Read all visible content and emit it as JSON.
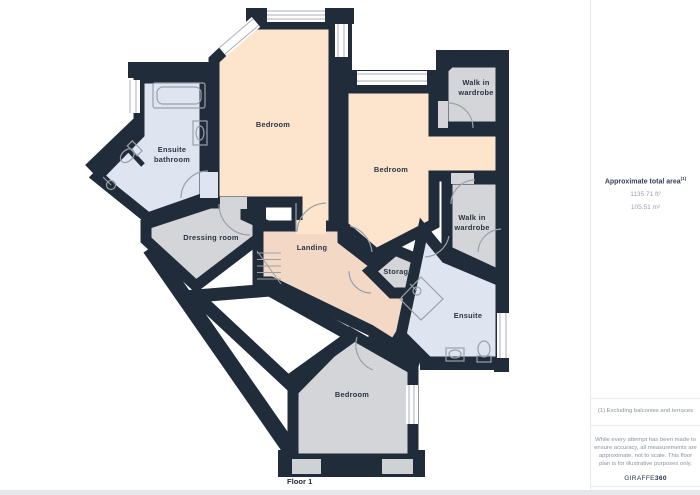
{
  "floorplan": {
    "floor_label": "Floor 1",
    "rooms": {
      "bedroom_top": "Bedroom",
      "bedroom_right": "Bedroom",
      "bedroom_bottom": "Bedroom",
      "ensuite_bathroom_l1": "Ensuite",
      "ensuite_bathroom_l2": "bathroom",
      "wiw_top_l1": "Walk in",
      "wiw_top_l2": "wardrobe",
      "wiw_bottom_l1": "Walk in",
      "wiw_bottom_l2": "wardrobe",
      "dressing_room": "Dressing room",
      "landing": "Landing",
      "storage": "Storage",
      "ensuite": "Ensuite"
    },
    "colors": {
      "wall": "#212c3a",
      "bedroom_fill": "#fce5cc",
      "landing_fill": "#f3d8c6",
      "ensuite_fill": "#dee4f0",
      "utility_fill": "#d3d5d8",
      "door_arc": "#9aa1ab"
    }
  },
  "panel": {
    "area_title": "Approximate total area",
    "note_ref": "(1)",
    "area_ft": "1135.71 ft²",
    "area_m": "105.51 m²",
    "note": "(1) Excluding balconies and terraces",
    "disclaimer": [
      "While every attempt has been made to",
      "ensure accuracy, all measurements are",
      "approximate, not to scale. This floor",
      "plan is for illustrative purposes only."
    ],
    "logo_normal": "GIRAFFE",
    "logo_bold": "360"
  }
}
